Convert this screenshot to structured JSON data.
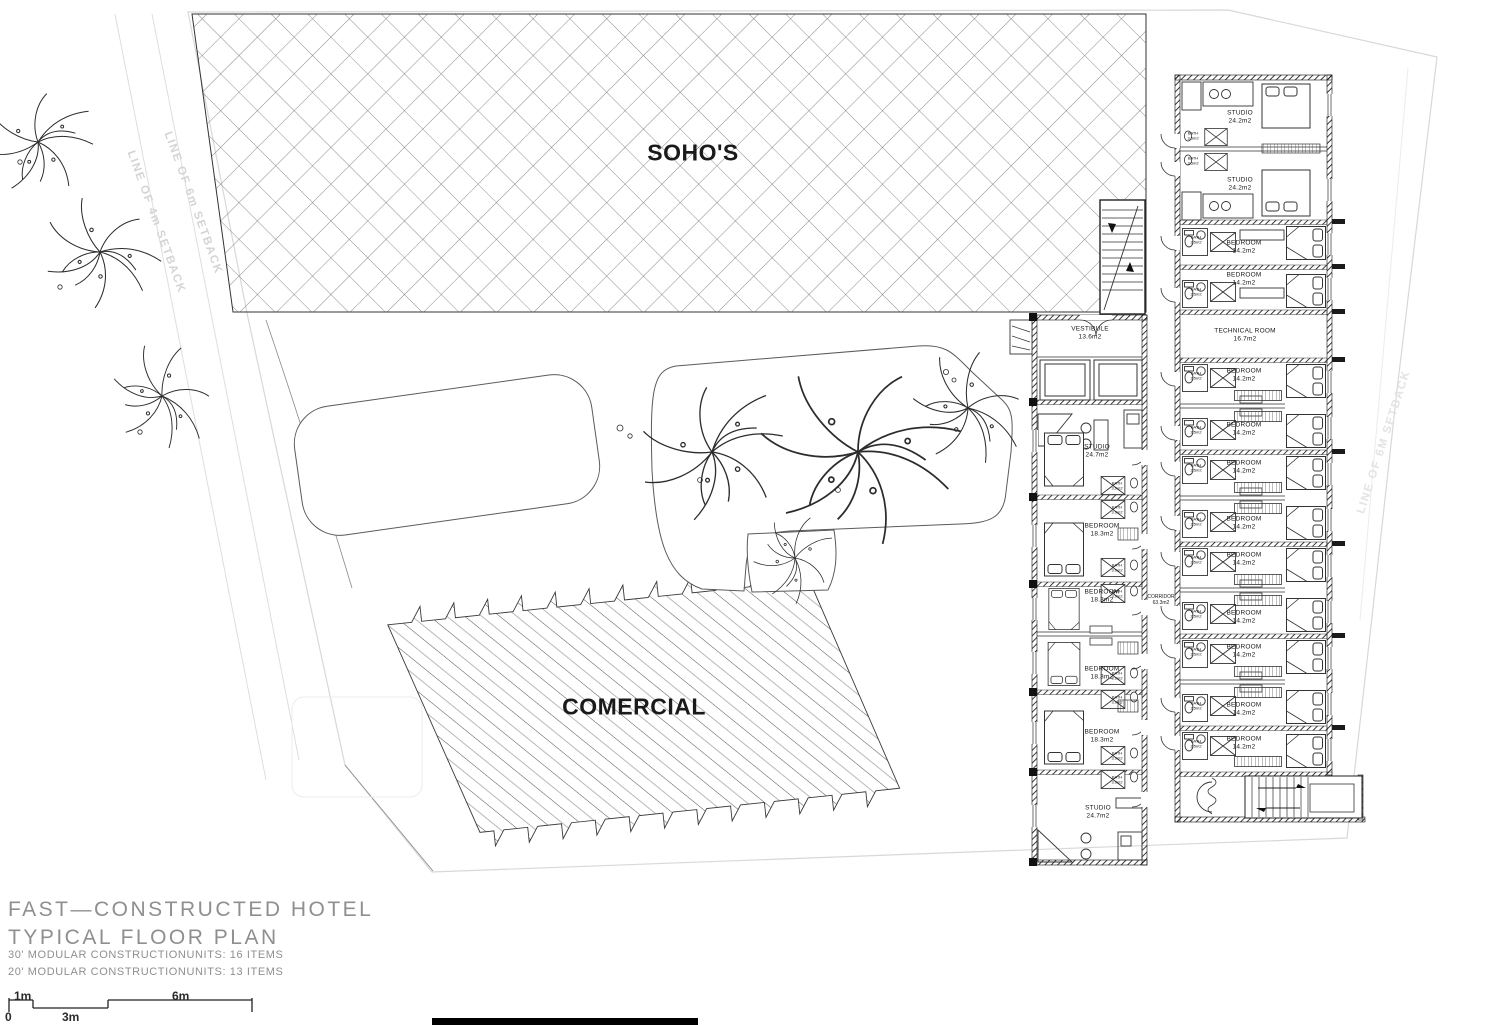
{
  "areas": {
    "sohos_label": "SOHO'S",
    "comercial_label": "COMERCIAL"
  },
  "setbacks": {
    "left_outer": "LINE OF 4m SETBACK",
    "left_inner": "LINE OF 6m SETBACK",
    "right": "LINE OF 6M SETBACK"
  },
  "building": {
    "vestibule": {
      "name": "VESTIBULE",
      "area": "13.6m2"
    },
    "corridor": {
      "name": "CORRIDOR",
      "area": "63.3m2"
    },
    "baths": {
      "studio": "BATH\n3.5m2",
      "bedroom": "BATH\n2.5m2",
      "west": "BATH\n3.9m2"
    },
    "right_wing": {
      "rooms": [
        {
          "name": "STUDIO",
          "area": "24.2m2"
        },
        {
          "name": "STUDIO",
          "area": "24.2m2"
        },
        {
          "name": "BEDROOM",
          "area": "14.2m2"
        },
        {
          "name": "BEDROOM",
          "area": "14.2m2"
        },
        {
          "name": "TECHNICAL ROOM",
          "area": "16.7m2"
        },
        {
          "name": "BEDROOM",
          "area": "14.2m2"
        },
        {
          "name": "BEDROOM",
          "area": "14.2m2"
        },
        {
          "name": "BEDROOM",
          "area": "14.2m2"
        },
        {
          "name": "BEDROOM",
          "area": "14.2m2"
        },
        {
          "name": "BEDROOM",
          "area": "14.2m2"
        },
        {
          "name": "BEDROOM",
          "area": "14.2m2"
        },
        {
          "name": "BEDROOM",
          "area": "14.2m2"
        },
        {
          "name": "BEDROOM",
          "area": "14.2m2"
        },
        {
          "name": "BEDROOM",
          "area": "14.2m2"
        }
      ]
    },
    "left_wing": {
      "rooms": [
        {
          "name": "STUDIO",
          "area": "24.7m2"
        },
        {
          "name": "BEDROOM",
          "area": "18.3m2"
        },
        {
          "name": "BEDROOM",
          "area": "18.3m2"
        },
        {
          "name": "BEDROOM",
          "area": "18.3m2"
        },
        {
          "name": "BEDROOM",
          "area": "18.3m2"
        },
        {
          "name": "STUDIO",
          "area": "24.7m2"
        }
      ]
    }
  },
  "title_block": {
    "line1": "FAST—CONSTRUCTED HOTEL",
    "line2": "TYPICAL FLOOR PLAN",
    "note1": "30' MODULAR CONSTRUCTIONUNITS: 16 ITEMS",
    "note2": "20' MODULAR CONSTRUCTIONUNITS: 13 ITEMS"
  },
  "scale_bar": {
    "zero": "0",
    "one_m": "1m",
    "three_m": "3m",
    "six_m": "6m"
  }
}
